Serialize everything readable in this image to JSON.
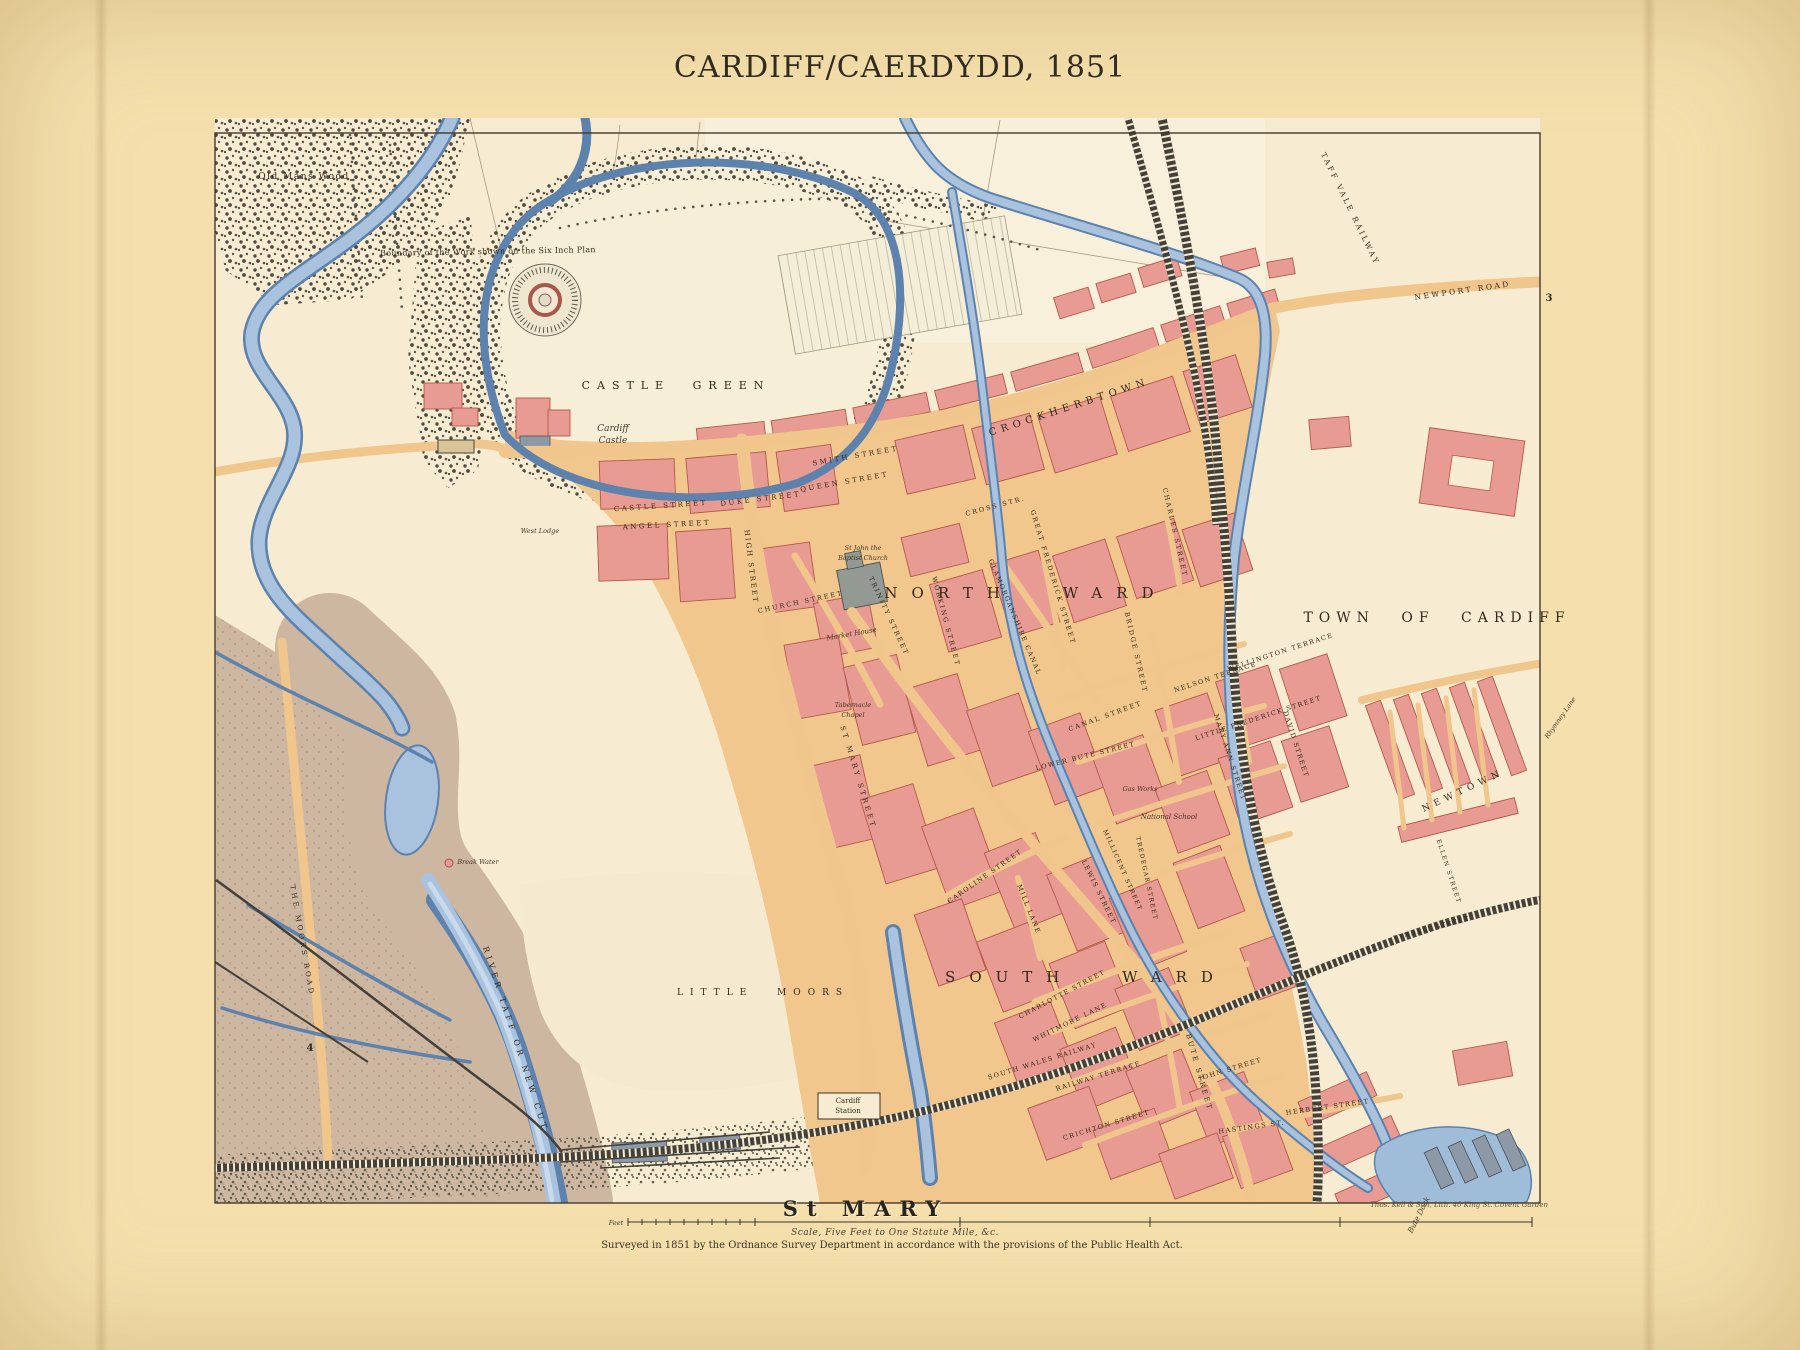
{
  "page": {
    "title": "CARDIFF/CAERDYDD, 1851"
  },
  "map": {
    "region": "Town of Cardiff, Ordnance Survey town plan",
    "colors": {
      "page_bg": "#f5e0ad",
      "sheet_bg": "#f7ecd2",
      "water_mid": "#a9c2dd",
      "water_edge": "#5c82ad",
      "block_pink": "#e89b92",
      "block_edge": "#b4584a",
      "road_tan": "#f1c68c",
      "moor_brown": "#cdb7a1",
      "rail_dark": "#44403a",
      "wood_dark": "#4d4b41",
      "ink": "#34291b"
    },
    "footer": {
      "parish": "St MARY",
      "scale_unit": "Feet",
      "scale_caption": "Scale, Five Feet to One Statute Mile, &c.",
      "survey_note": "Surveyed in 1851 by the Ordnance Survey Department in accordance with the provisions of the Public Health Act.",
      "lithographer": "Thos. Kell & Son, Lith. 40 King St. Covent Garden"
    },
    "labels": [
      {
        "name": "old-mans-wood-label",
        "text": "Old Mans Wood",
        "x": 304,
        "y": 179,
        "fs": 9,
        "ls": 1.5
      },
      {
        "name": "boundary-note",
        "text": "Boundary of the Work shown on the Six Inch Plan",
        "x": 488,
        "y": 254,
        "rot": -1,
        "fs": 8,
        "ls": 0.3
      },
      {
        "name": "castle-green-label",
        "text": "CASTLE GREEN",
        "x": 676,
        "y": 389,
        "fs": 11,
        "ls": 7,
        "ws": 12
      },
      {
        "name": "cardiff-castle-label-1",
        "text": "Cardiff",
        "x": 613,
        "y": 431,
        "fs": 9,
        "cls": "it"
      },
      {
        "name": "cardiff-castle-label-2",
        "text": "Castle",
        "x": 613,
        "y": 443,
        "fs": 9,
        "cls": "it"
      },
      {
        "name": "west-lodge-label",
        "text": "West Lodge",
        "x": 540,
        "y": 533,
        "fs": 6.5,
        "cls": "it"
      },
      {
        "name": "crockherbtown-label",
        "text": "CROCKHERBTOWN",
        "x": 1070,
        "y": 410,
        "rot": -18,
        "fs": 10,
        "ls": 5
      },
      {
        "name": "smith-street-label",
        "text": "SMITH STREET",
        "x": 856,
        "y": 458,
        "rot": -10,
        "fs": 7,
        "ls": 2.5
      },
      {
        "name": "queen-street-label",
        "text": "QUEEN STREET",
        "x": 845,
        "y": 484,
        "rot": -10,
        "fs": 7,
        "ls": 2.5
      },
      {
        "name": "duke-street-label",
        "text": "DUKE STREET",
        "x": 761,
        "y": 501,
        "rot": -7,
        "fs": 7,
        "ls": 2.5
      },
      {
        "name": "castle-street-label",
        "text": "CASTLE STREET",
        "x": 661,
        "y": 508,
        "rot": -4,
        "fs": 7,
        "ls": 2.5
      },
      {
        "name": "angel-street-label",
        "text": "ANGEL STREET",
        "x": 667,
        "y": 527,
        "rot": -3,
        "fs": 7,
        "ls": 2.5
      },
      {
        "name": "high-street-label",
        "text": "HIGH STREET",
        "x": 749,
        "y": 567,
        "rot": 83,
        "fs": 7,
        "ls": 2
      },
      {
        "name": "church-street-label",
        "text": "CHURCH STREET",
        "x": 801,
        "y": 604,
        "rot": -12,
        "fs": 6.5,
        "ls": 2
      },
      {
        "name": "trinity-street-label",
        "text": "TRINITY STREET",
        "x": 887,
        "y": 617,
        "rot": 65,
        "fs": 6.5,
        "ls": 2
      },
      {
        "name": "market-house-label",
        "text": "Market House",
        "x": 852,
        "y": 636,
        "rot": -10,
        "fs": 7,
        "cls": "it"
      },
      {
        "name": "st-john-church-label-1",
        "text": "St John the",
        "x": 863,
        "y": 550,
        "fs": 6.5,
        "cls": "it"
      },
      {
        "name": "st-john-church-label-2",
        "text": "Baptist Church",
        "x": 863,
        "y": 560,
        "fs": 6.5,
        "cls": "it"
      },
      {
        "name": "working-street-label",
        "text": "WORKING STREET",
        "x": 944,
        "y": 622,
        "rot": 75,
        "fs": 6.5,
        "ls": 2
      },
      {
        "name": "cross-street-label",
        "text": "CROSS STR.",
        "x": 996,
        "y": 508,
        "rot": -15,
        "fs": 6.5,
        "ls": 2
      },
      {
        "name": "north-ward-label",
        "text": "NORTH WARD",
        "x": 1026,
        "y": 598,
        "fs": 15,
        "ls": 14,
        "ws": 30
      },
      {
        "name": "glamorganshire-canal-label",
        "text": "GLAMORGANSHIRE CANAL",
        "x": 1013,
        "y": 618,
        "rot": 67,
        "fs": 6.5,
        "ls": 1.5
      },
      {
        "name": "bridge-street-label",
        "text": "BRIDGE STREET",
        "x": 1134,
        "y": 653,
        "rot": 77,
        "fs": 6.5,
        "ls": 2
      },
      {
        "name": "great-frederick-street-label",
        "text": "GREAT FREDERICK STREET",
        "x": 1051,
        "y": 578,
        "rot": 73,
        "fs": 6.5,
        "ls": 2
      },
      {
        "name": "charles-street-label",
        "text": "CHARLES STREET",
        "x": 1173,
        "y": 533,
        "rot": 77,
        "fs": 6.5,
        "ls": 2
      },
      {
        "name": "nelson-terrace-label",
        "text": "NELSON TERRACE",
        "x": 1216,
        "y": 679,
        "rot": -18,
        "fs": 6.5,
        "ls": 1.5
      },
      {
        "name": "wellington-terrace-label",
        "text": "WELLINGTON TERRACE",
        "x": 1281,
        "y": 654,
        "rot": -18,
        "fs": 6.5,
        "ls": 1.5
      },
      {
        "name": "little-frederick-street-label",
        "text": "LITTLE FREDERICK STREET",
        "x": 1259,
        "y": 720,
        "rot": -18,
        "fs": 6.5,
        "ls": 1.5
      },
      {
        "name": "mary-ann-street-label",
        "text": "MARY ANN STREET",
        "x": 1228,
        "y": 758,
        "rot": 72,
        "fs": 6.5,
        "ls": 1.5
      },
      {
        "name": "david-street-label",
        "text": "DAVID STREET",
        "x": 1294,
        "y": 745,
        "rot": 72,
        "fs": 6.5,
        "ls": 1.5
      },
      {
        "name": "canal-street-label",
        "text": "CANAL STREET",
        "x": 1106,
        "y": 718,
        "rot": -20,
        "fs": 6.5,
        "ls": 2
      },
      {
        "name": "town-of-cardiff-label",
        "text": "TOWN OF CARDIFF",
        "x": 1437,
        "y": 622,
        "fs": 14,
        "ls": 6,
        "ws": 16
      },
      {
        "name": "newtown-label",
        "text": "NEWTOWN",
        "x": 1464,
        "y": 793,
        "rot": -25,
        "fs": 9,
        "ls": 5
      },
      {
        "name": "ellen-street-label",
        "text": "ELLEN STREET",
        "x": 1447,
        "y": 872,
        "rot": 72,
        "fs": 6,
        "ls": 1.5
      },
      {
        "name": "tyndall-street-label",
        "text": "TYNDALL STREET",
        "x": 1432,
        "y": 930,
        "rot": -15,
        "fs": 6,
        "ls": 1.5
      },
      {
        "name": "st-mary-street-label",
        "text": "ST MARY STREET",
        "x": 856,
        "y": 778,
        "rot": 73,
        "fs": 7,
        "ls": 3
      },
      {
        "name": "lower-bute-street-label",
        "text": "LOWER BUTE STREET",
        "x": 1086,
        "y": 758,
        "rot": -14,
        "fs": 6.5,
        "ls": 1.5
      },
      {
        "name": "bute-street-label",
        "text": "BUTE STREET",
        "x": 1197,
        "y": 1073,
        "rot": 74,
        "fs": 7,
        "ls": 2.5
      },
      {
        "name": "caroline-street-label",
        "text": "CAROLINE STREET",
        "x": 986,
        "y": 878,
        "rot": -35,
        "fs": 6.5,
        "ls": 1.5
      },
      {
        "name": "mill-lane-label",
        "text": "MILL LANE",
        "x": 1027,
        "y": 910,
        "rot": 68,
        "fs": 6.5,
        "ls": 1.5
      },
      {
        "name": "south-ward-label",
        "text": "SOUTH WARD",
        "x": 1086,
        "y": 982,
        "fs": 15,
        "ls": 14,
        "ws": 30
      },
      {
        "name": "charlotte-street-label",
        "text": "CHARLOTTE STREET",
        "x": 1063,
        "y": 996,
        "rot": -28,
        "fs": 6.5,
        "ls": 1.5
      },
      {
        "name": "whitmore-lane-label",
        "text": "WHITMORE LANE",
        "x": 1071,
        "y": 1024,
        "rot": -26,
        "fs": 6.5,
        "ls": 1.5
      },
      {
        "name": "lewis-street-label",
        "text": "LEWIS STREET",
        "x": 1097,
        "y": 893,
        "rot": 64,
        "fs": 6.5,
        "ls": 1.5
      },
      {
        "name": "millicent-street-label",
        "text": "MILLICENT STREET",
        "x": 1121,
        "y": 871,
        "rot": 66,
        "fs": 6,
        "ls": 1.5
      },
      {
        "name": "tredegar-street-label",
        "text": "TREDEGAR STREET",
        "x": 1145,
        "y": 879,
        "rot": 78,
        "fs": 6,
        "ls": 1.5
      },
      {
        "name": "south-wales-railway-label",
        "text": "SOUTH WALES RAILWAY",
        "x": 1043,
        "y": 1063,
        "rot": -17,
        "fs": 6.5,
        "ls": 1.5
      },
      {
        "name": "railway-terrace-label",
        "text": "RAILWAY TERRACE",
        "x": 1099,
        "y": 1078,
        "rot": -17,
        "fs": 6.5,
        "ls": 1.5
      },
      {
        "name": "crichton-street-label",
        "text": "CRICHTON STREET",
        "x": 1107,
        "y": 1127,
        "rot": -17,
        "fs": 6.5,
        "ls": 1.5
      },
      {
        "name": "john-street-label",
        "text": "JOHN STREET",
        "x": 1231,
        "y": 1071,
        "rot": -17,
        "fs": 6.5,
        "ls": 1.5
      },
      {
        "name": "hastings-street-label",
        "text": "HASTINGS ST.",
        "x": 1252,
        "y": 1129,
        "rot": -8,
        "fs": 6.5,
        "ls": 1.5
      },
      {
        "name": "herbert-street-label",
        "text": "HERBERT STREET",
        "x": 1328,
        "y": 1109,
        "rot": -8,
        "fs": 6.5,
        "ls": 1.5
      },
      {
        "name": "national-school-label",
        "text": "National School",
        "x": 1169,
        "y": 819,
        "fs": 7,
        "cls": "it"
      },
      {
        "name": "gas-works-label",
        "text": "Gas Works",
        "x": 1140,
        "y": 791,
        "fs": 6.5,
        "cls": "it"
      },
      {
        "name": "tabernacle-chapel-label-1",
        "text": "Tabernacle",
        "x": 853,
        "y": 707,
        "fs": 6.5,
        "cls": "it"
      },
      {
        "name": "tabernacle-chapel-label-2",
        "text": "Chapel",
        "x": 853,
        "y": 717,
        "fs": 6.5,
        "cls": "it"
      },
      {
        "name": "little-moors-label",
        "text": "LITTLE MOORS",
        "x": 763,
        "y": 995,
        "fs": 9,
        "ls": 7,
        "ws": 14
      },
      {
        "name": "river-taff-label",
        "text": "RIVER TAFF OR NEW CUT",
        "x": 513,
        "y": 1040,
        "rot": 72,
        "fs": 8,
        "ls": 4
      },
      {
        "name": "moors-road-label",
        "text": "THE MOORS ROAD",
        "x": 300,
        "y": 941,
        "rot": 80,
        "fs": 7,
        "ls": 3
      },
      {
        "name": "break-water-label",
        "text": "Break Water",
        "x": 478,
        "y": 864,
        "fs": 6.5,
        "cls": "it"
      },
      {
        "name": "cardiff-station-label-1",
        "text": "Cardiff",
        "x": 848,
        "y": 1103,
        "fs": 7
      },
      {
        "name": "cardiff-station-label-2",
        "text": "Station",
        "x": 848,
        "y": 1113,
        "fs": 7
      },
      {
        "name": "taff-vale-railway-label",
        "text": "TAFF VALE RAILWAY",
        "x": 1348,
        "y": 210,
        "rot": 64,
        "fs": 7.5,
        "ls": 2.5
      },
      {
        "name": "newport-road-label",
        "text": "NEWPORT ROAD",
        "x": 1463,
        "y": 293,
        "rot": -8,
        "fs": 7.5,
        "ls": 2.5
      },
      {
        "name": "rhymney-lane-label",
        "text": "Rhymney Lane",
        "x": 1562,
        "y": 719,
        "rot": -55,
        "fs": 6.5,
        "cls": "it"
      },
      {
        "name": "bute-dock-label",
        "text": "Bute Dock",
        "x": 1421,
        "y": 1216,
        "rot": -63,
        "fs": 7.5,
        "cls": "it"
      },
      {
        "name": "sheet-number-3",
        "text": "3",
        "x": 1549,
        "y": 301,
        "fs": 10,
        "cls": "bd"
      },
      {
        "name": "sheet-number-4",
        "text": "4",
        "x": 310,
        "y": 1051,
        "fs": 10,
        "cls": "bd"
      },
      {
        "name": "scale-feet-label",
        "text": "Feet",
        "x": 616,
        "y": 1225,
        "fs": 6.5,
        "cls": "it"
      }
    ]
  }
}
